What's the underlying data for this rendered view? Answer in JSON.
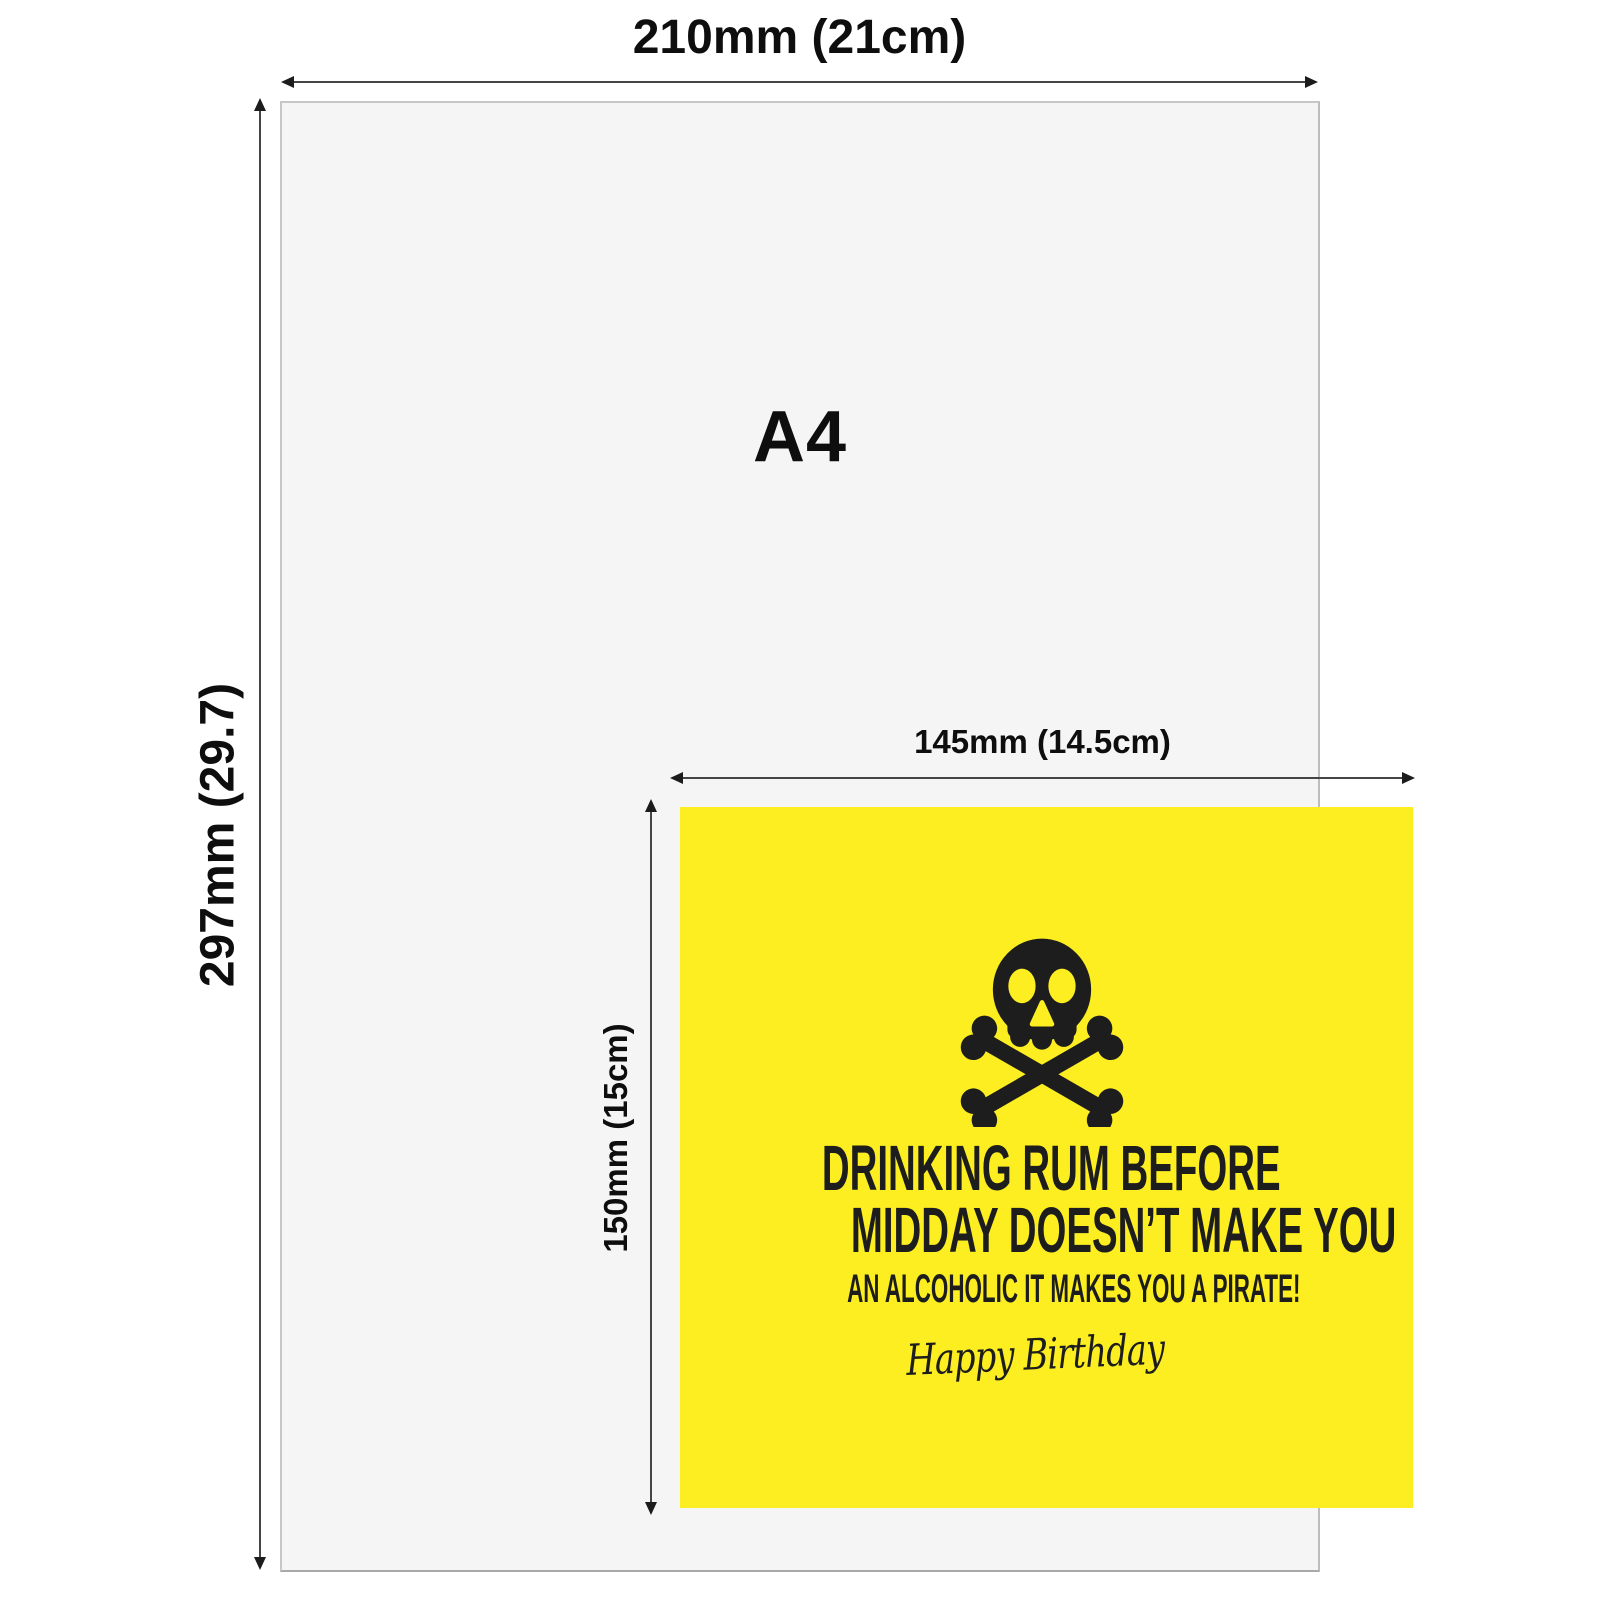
{
  "page": {
    "background": "#ffffff",
    "arrow_color": "#454545",
    "label_color": "#0e0e0e"
  },
  "a4": {
    "label": "A4",
    "width_label": "210mm (21cm)",
    "height_label": "297mm (29.7)",
    "fill": "#f5f5f5",
    "border": "#c7c7c7"
  },
  "card": {
    "width_label": "145mm (14.5cm)",
    "height_label": "150mm (15cm)",
    "fill": "#fcee21",
    "ink": "#1d1d1d",
    "icon": "skull-and-crossbones-icon",
    "line1": "DRINKING RUM BEFORE",
    "line2": "MIDDAY DOESN’T MAKE YOU",
    "line3": "AN ALCOHOLIC IT MAKES YOU A PIRATE!",
    "script": "Happy Birthday"
  }
}
